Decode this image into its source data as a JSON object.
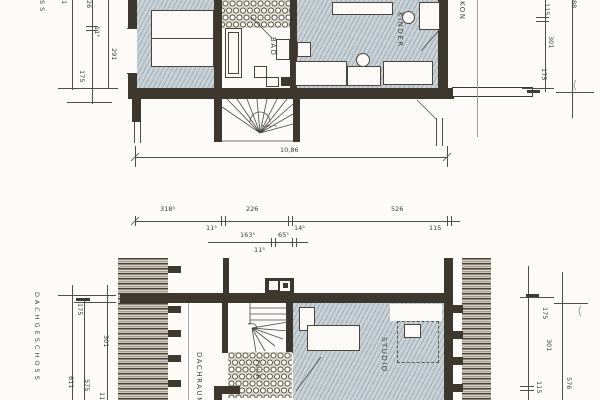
{
  "sheet": {
    "floor_label_upper_partial": "SS",
    "floor_label_lower": "DACHGESCHOSS",
    "overall_width": "10,86"
  },
  "rooms": {
    "kinder": "KINDER",
    "bad": "BAD",
    "balkon_partial": "KON",
    "studio": "STUDIO",
    "dachraum": "DACHRAUM",
    "flur": "FLUR"
  },
  "dims": {
    "upper_left": [
      "1",
      "26",
      "11⁵",
      "291",
      "175"
    ],
    "upper_right": [
      "115",
      "301",
      "175",
      "88"
    ],
    "middle_main": [
      "318⁵",
      "11⁵",
      "226",
      "14⁵",
      "526",
      "115"
    ],
    "middle_sub": [
      "163⁵",
      "11⁵",
      "65⁵"
    ],
    "lower_left": [
      "175",
      "301",
      "611",
      "575",
      "115"
    ],
    "lower_right": [
      "175",
      "301",
      "115",
      "576"
    ]
  },
  "colors": {
    "wall": "#3e372d",
    "floor": "#c5cfd4",
    "paper": "#fcfbf8"
  }
}
